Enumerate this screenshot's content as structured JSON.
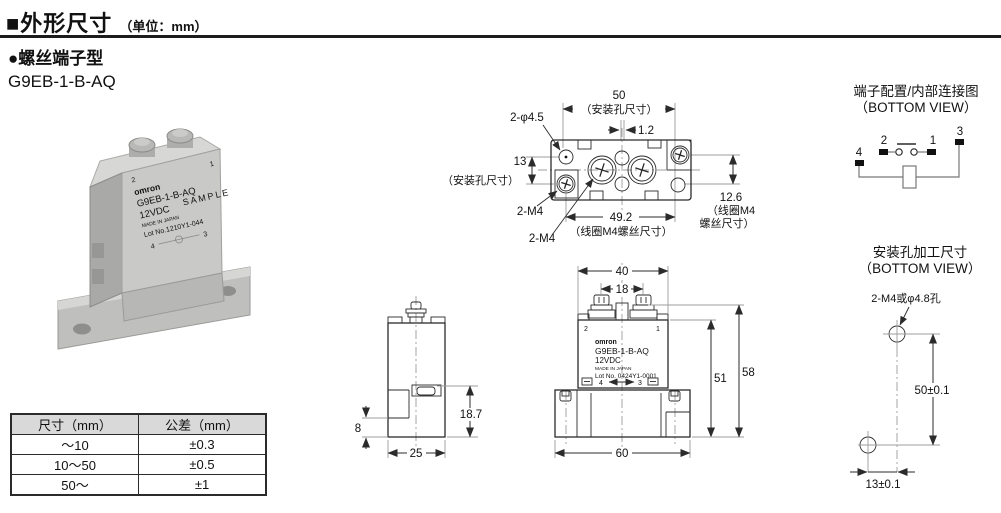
{
  "page": {
    "title": "■外形尺寸",
    "unit": "（单位：mm）",
    "section": "●螺丝端子型",
    "model": "G9EB-1-B-AQ"
  },
  "photo": {
    "brand": "omron",
    "model": "G9EB-1-B-AQ",
    "voltage": "12VDC",
    "sample": "SAMPLE",
    "made_in": "MADE IN JAPAN",
    "lot": "Lot No.1210Y1-044",
    "t1": "1",
    "t2": "2",
    "t3": "3",
    "t4": "4"
  },
  "top_view": {
    "dim_50": "50",
    "dim_50_note": "（安装孔尺寸）",
    "dim_1_2": "1.2",
    "label_phi": "2-φ4.5",
    "dim_13": "13",
    "dim_13_note": "（安装孔尺寸）",
    "label_m4": "2-M4",
    "dim_49_2": "49.2",
    "dim_49_2_note": "（线圈M4螺丝尺寸）",
    "dim_12_6": "12.6",
    "dim_12_6_note1": "（线圈M4",
    "dim_12_6_note2": "螺丝尺寸）"
  },
  "circuit": {
    "title": "端子配置/内部连接图",
    "subtitle": "（BOTTOM VIEW）",
    "t1": "1",
    "t2": "2",
    "t3": "3",
    "t4": "4"
  },
  "mounting": {
    "title": "安装孔加工尺寸",
    "subtitle": "（BOTTOM VIEW）",
    "hole_label": "2-M4或φ4.8孔",
    "dim_v": "50±0.1",
    "dim_h": "13±0.1"
  },
  "side_view": {
    "dim_8": "8",
    "dim_18_7": "18.7",
    "dim_25": "25"
  },
  "front_view": {
    "dim_40": "40",
    "dim_18": "18",
    "dim_51": "51",
    "dim_58": "58",
    "dim_60": "60",
    "brand": "omron",
    "model": "G9EB-1-B-AQ",
    "voltage": "12VDC",
    "made_in": "MADE IN JAPAN",
    "lot": "Lot No. 0424Y1-0001",
    "t1": "1",
    "t2": "2",
    "t3": "3",
    "t4": "4"
  },
  "tolerance_table": {
    "headers": [
      "尺寸（mm）",
      "公差（mm）"
    ],
    "rows": [
      [
        "～10",
        "±0.3"
      ],
      [
        "10～50",
        "±0.5"
      ],
      [
        "50～",
        "±1"
      ]
    ]
  },
  "colors": {
    "line": "#2b2b2b",
    "extension_line": "#9c9c9c",
    "table_header_bg": "#d9d9d9",
    "photo_body": "#c9c9c7"
  }
}
